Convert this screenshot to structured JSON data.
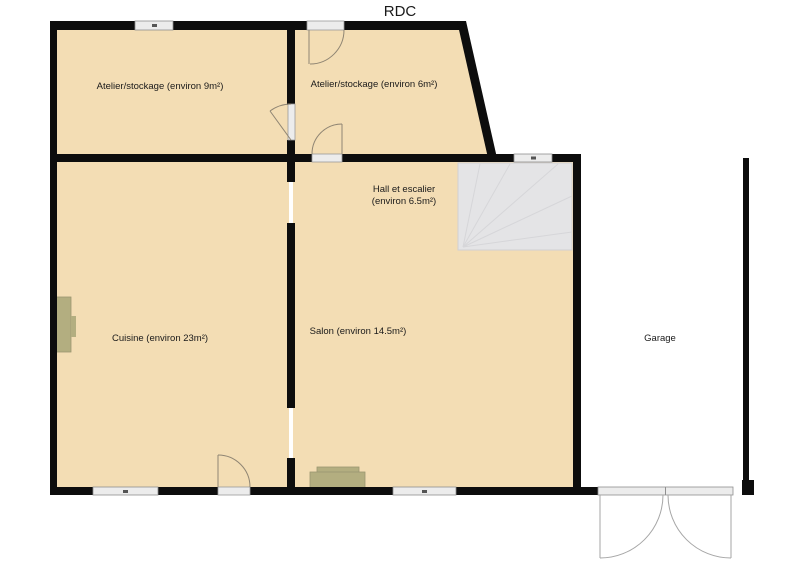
{
  "title": "RDC",
  "rooms": {
    "atelier9": {
      "label": "Atelier/stockage (environ 9m²)"
    },
    "atelier6": {
      "label": "Atelier/stockage (environ 6m²)"
    },
    "hall": {
      "label_line1": "Hall et escalier",
      "label_line2": "(environ 6.5m²)"
    },
    "cuisine": {
      "label": "Cuisine (environ 23m²)"
    },
    "salon": {
      "label": "Salon (environ 14.5m²)"
    },
    "garage": {
      "label": "Garage"
    }
  },
  "colors": {
    "floor": "#f3ddb4",
    "wall": "#0d0d0d",
    "stairs_fill": "#e4e4e6",
    "stairs_line": "#d6d6d9",
    "window_fill": "#ececec",
    "door_line": "#8f8573",
    "garage_door_line": "#a6a6a6",
    "furniture": "#b3ae80"
  }
}
